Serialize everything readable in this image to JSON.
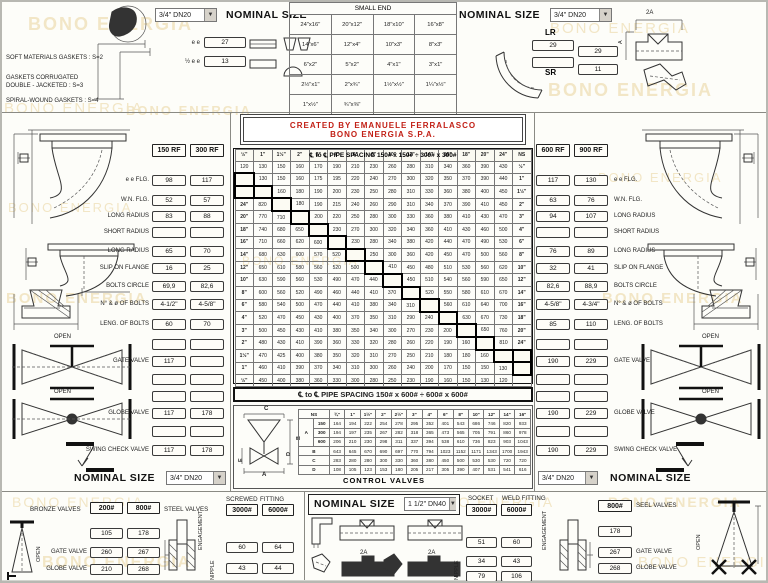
{
  "watermark_color": "#f2e6c6",
  "watermarks": [
    {
      "t": "BONO ENERGIA",
      "x": 26,
      "y": 12,
      "s": 18,
      "b": 1
    },
    {
      "t": "BONO ENERGIA",
      "x": 2,
      "y": 98,
      "s": 15,
      "b": 0
    },
    {
      "t": "BONO ENERGIA",
      "x": 124,
      "y": 101,
      "s": 13,
      "b": 1
    },
    {
      "t": "BONO ENERGIA",
      "x": 548,
      "y": 18,
      "s": 15,
      "b": 0
    },
    {
      "t": "BONO ENERGIA",
      "x": 546,
      "y": 78,
      "s": 18,
      "b": 1
    },
    {
      "t": "BONO ENERGIA",
      "x": 596,
      "y": 168,
      "s": 13,
      "b": 0
    },
    {
      "t": "BONO ENERGIA",
      "x": 600,
      "y": 288,
      "s": 15,
      "b": 1
    },
    {
      "t": "BONO ENERGIA",
      "x": 6,
      "y": 198,
      "s": 13,
      "b": 0
    },
    {
      "t": "BONO ENERGIA",
      "x": 4,
      "y": 288,
      "s": 15,
      "b": 1
    },
    {
      "t": "BONO ENERGIA",
      "x": 240,
      "y": 252,
      "s": 12,
      "b": 0
    },
    {
      "t": "BONO ENERGIA",
      "x": 10,
      "y": 492,
      "s": 14,
      "b": 0
    },
    {
      "t": "BONO ENERGIA",
      "x": 420,
      "y": 492,
      "s": 14,
      "b": 0
    },
    {
      "t": "BONO ENERGIA",
      "x": 606,
      "y": 492,
      "s": 14,
      "b": 1
    },
    {
      "t": "BONO ENERGIA",
      "x": 40,
      "y": 552,
      "s": 16,
      "b": 1
    },
    {
      "t": "BONO ENERGIA",
      "x": 636,
      "y": 552,
      "s": 15,
      "b": 0
    }
  ],
  "top_left": {
    "dropdown": "3/4\" DN20",
    "nominal_size": "NOMINAL SIZE",
    "dims": [
      {
        "label": "e e",
        "value": "27"
      },
      {
        "label": "½ e e",
        "value": "13"
      }
    ],
    "notes": [
      "SOFT MATERIALS GASKETS : S=2",
      "GASKETS CORRUGATED",
      "DOUBLE - JACKETED      : S=3",
      "SPIRAL-WOUND GASKETS  : S=4"
    ]
  },
  "small_end": {
    "title": "SMALL END",
    "rows": [
      [
        "24\"x16\"",
        "20\"x12\"",
        "18\"x10\"",
        "16\"x8\""
      ],
      [
        "14\"x6\"",
        "12\"x4\"",
        "10\"x3\"",
        "8\"x3\""
      ],
      [
        "6\"x2\"",
        "5\"x2\"",
        "4\"x1\"",
        "3\"x1\""
      ],
      [
        "2½\"x1\"",
        "2\"x¾\"",
        "1½\"x½\"",
        "1¼\"x½\""
      ],
      [
        "1\"x½\"",
        "¾\"x⅜\"",
        "",
        ""
      ]
    ]
  },
  "top_right": {
    "nominal_size": "NOMINAL SIZE",
    "dropdown": "3/4\" DN20",
    "lr_label": "LR",
    "sr_label": "SR",
    "lr_value": "29",
    "mid_value": "29",
    "sr_value": "11",
    "dim_2a": "2A",
    "dim_a": "A"
  },
  "credit": {
    "line1": "CREATED BY EMANUELE FERRALASCO",
    "line2": "BONO ENERGIA S.P.A."
  },
  "spacing": {
    "title": "℄ to ℄ PIPE SPACING 150# x 150# ÷ 300# x 300#",
    "top_header": [
      "½\"",
      "1\"",
      "1½\"",
      "2\"",
      "3\"",
      "4\"",
      "6\"",
      "8\"",
      "10\"",
      "12\"",
      "14\"",
      "16\"",
      "18\"",
      "20\"",
      "24\"",
      "NS"
    ],
    "bottom_header": [
      "NS",
      "24\"",
      "20\"",
      "18\"",
      "16\"",
      "14\"",
      "12\"",
      "10\"",
      "8\"",
      "6\"",
      "4\"",
      "3\"",
      "2\"",
      "1½\"",
      "1\"",
      "½\""
    ],
    "rows": [
      {
        "left": "",
        "right": "½\"",
        "cells": [
          120,
          130,
          150,
          160,
          170,
          190,
          210,
          230,
          260,
          280,
          310,
          340,
          360,
          390,
          430
        ]
      },
      {
        "left": "",
        "right": "1\"",
        "cells": [
          null,
          130,
          150,
          160,
          175,
          195,
          220,
          240,
          270,
          300,
          320,
          350,
          370,
          390,
          440
        ]
      },
      {
        "left": "",
        "right": "1½\"",
        "cells": [
          null,
          null,
          160,
          180,
          190,
          200,
          230,
          250,
          280,
          310,
          330,
          360,
          380,
          400,
          450
        ]
      },
      {
        "left": "24\"",
        "right": "2\"",
        "cells": [
          820,
          null,
          180,
          190,
          215,
          240,
          260,
          290,
          310,
          340,
          370,
          390,
          410,
          450
        ]
      },
      {
        "left": "20\"",
        "right": "3\"",
        "cells": [
          770,
          710,
          null,
          200,
          220,
          250,
          280,
          300,
          330,
          360,
          380,
          410,
          430,
          470
        ]
      },
      {
        "left": "18\"",
        "right": "4\"",
        "cells": [
          740,
          680,
          650,
          null,
          230,
          270,
          300,
          320,
          340,
          360,
          410,
          430,
          460,
          500
        ]
      },
      {
        "left": "16\"",
        "right": "6\"",
        "cells": [
          710,
          660,
          620,
          600,
          null,
          230,
          280,
          340,
          380,
          420,
          440,
          470,
          490,
          530
        ]
      },
      {
        "left": "14\"",
        "right": "8\"",
        "cells": [
          680,
          630,
          600,
          570,
          520,
          null,
          250,
          300,
          360,
          420,
          450,
          470,
          500,
          560
        ]
      },
      {
        "left": "12\"",
        "right": "10\"",
        "cells": [
          650,
          610,
          580,
          560,
          520,
          500,
          null,
          410,
          450,
          480,
          510,
          530,
          560,
          620
        ]
      },
      {
        "left": "10\"",
        "right": "12\"",
        "cells": [
          630,
          590,
          560,
          530,
          490,
          470,
          440,
          null,
          450,
          510,
          540,
          560,
          590,
          650
        ]
      },
      {
        "left": "8\"",
        "right": "14\"",
        "cells": [
          600,
          560,
          520,
          490,
          460,
          440,
          410,
          370,
          null,
          520,
          550,
          580,
          610,
          670
        ]
      },
      {
        "left": "6\"",
        "right": "16\"",
        "cells": [
          580,
          540,
          500,
          470,
          440,
          410,
          380,
          340,
          310,
          null,
          560,
          610,
          640,
          700
        ]
      },
      {
        "left": "4\"",
        "right": "18\"",
        "cells": [
          520,
          470,
          450,
          430,
          400,
          370,
          350,
          310,
          290,
          240,
          null,
          630,
          670,
          730
        ]
      },
      {
        "left": "3\"",
        "right": "20\"",
        "cells": [
          500,
          450,
          430,
          410,
          380,
          350,
          340,
          300,
          270,
          230,
          200,
          null,
          650,
          760
        ]
      },
      {
        "left": "2\"",
        "right": "24\"",
        "cells": [
          480,
          430,
          410,
          390,
          360,
          330,
          320,
          280,
          260,
          220,
          190,
          160,
          null,
          810
        ]
      },
      {
        "left": "1½\"",
        "right": "",
        "cells": [
          470,
          425,
          400,
          380,
          350,
          320,
          310,
          270,
          250,
          210,
          180,
          180,
          160,
          null
        ]
      },
      {
        "left": "1\"",
        "right": "",
        "cells": [
          460,
          410,
          390,
          370,
          340,
          310,
          300,
          260,
          240,
          200,
          170,
          150,
          150,
          130
        ]
      },
      {
        "left": "½\"",
        "right": "",
        "cells": [
          450,
          400,
          380,
          360,
          330,
          300,
          280,
          250,
          230,
          190,
          160,
          150,
          130,
          120
        ]
      }
    ]
  },
  "band2": "℄ to ℄ PIPE SPACING 150# x 600# ÷ 600# x 600#",
  "control_valves": {
    "title": "CONTROL VALVES",
    "ns_label": "NS",
    "header": [
      "¾\"",
      "1\"",
      "1½\"",
      "2\"",
      "2½\"",
      "3\"",
      "4\"",
      "6\"",
      "8\"",
      "10\"",
      "12\"",
      "14\"",
      "16\""
    ],
    "group_a": {
      "label": "A",
      "subrows": [
        {
          "label": "150",
          "values": [
            164,
            194,
            222,
            254,
            278,
            295,
            352,
            401,
            543,
            686,
            746,
            820,
            933
          ]
        },
        {
          "label": "300",
          "values": [
            194,
            197,
            235,
            267,
            282,
            318,
            365,
            473,
            565,
            705,
            791,
            860,
            978
          ]
        },
        {
          "label": "600",
          "values": [
            206,
            210,
            230,
            298,
            311,
            337,
            394,
            538,
            610,
            736,
            823,
            903,
            1043
          ]
        }
      ]
    },
    "rows": [
      {
        "label": "B",
        "values": [
          643,
          645,
          670,
          690,
          697,
          770,
          794,
          1023,
          1152,
          1171,
          1343,
          1700,
          1943
        ]
      },
      {
        "label": "C",
        "values": [
          283,
          280,
          280,
          300,
          330,
          360,
          380,
          450,
          500,
          530,
          530,
          720,
          720
        ]
      },
      {
        "label": "D",
        "values": [
          108,
          105,
          123,
          153,
          180,
          205,
          217,
          305,
          390,
          407,
          531,
          541,
          616
        ]
      }
    ],
    "drawing_letters": {
      "top": "C",
      "right": "B",
      "left": "E",
      "bottom": "A",
      "mid": "D"
    }
  },
  "left_panel": {
    "headers": [
      "150 RF",
      "300 RF"
    ],
    "rows": [
      {
        "label": "e e FLG.",
        "v": [
          "98",
          "117"
        ]
      },
      {
        "label": "W.N. FLG.",
        "v": [
          "52",
          "57"
        ]
      },
      {
        "label": "LONG RADIUS",
        "v": [
          "83",
          "88"
        ]
      },
      {
        "label": "SHORT RADIUS",
        "v": [
          "",
          ""
        ]
      },
      {
        "label": "LONG RADIUS",
        "v": [
          "65",
          "70"
        ]
      },
      {
        "label": "SLIP ON FLANGE",
        "v": [
          "16",
          "25"
        ]
      },
      {
        "label": "BOLTS CIRCLE",
        "v": [
          "69,9",
          "82,6"
        ]
      },
      {
        "label": "N° & ø OF BOLTS",
        "v": [
          "4-1/2\"",
          "4-5/8\""
        ]
      },
      {
        "label": "LENG. OF BOLTS",
        "v": [
          "60",
          "70"
        ]
      }
    ]
  },
  "right_panel": {
    "headers": [
      "600 RF",
      "900 RF"
    ],
    "rows": [
      {
        "label": "e e FLG.",
        "v": [
          "117",
          "130"
        ]
      },
      {
        "label": "W.N. FLG.",
        "v": [
          "63",
          "76"
        ]
      },
      {
        "label": "LONG RADIUS",
        "v": [
          "94",
          "107"
        ]
      },
      {
        "label": "SHORT RADIUS",
        "v": [
          "",
          ""
        ]
      },
      {
        "label": "LONG RADIUS",
        "v": [
          "76",
          "89"
        ]
      },
      {
        "label": "SLIP ON FLANGE",
        "v": [
          "32",
          "41"
        ]
      },
      {
        "label": "BOLTS CIRCLE",
        "v": [
          "82,6",
          "88,9"
        ]
      },
      {
        "label": "N° & ø OF BOLTS",
        "v": [
          "4-5/8\"",
          "4-3/4\""
        ]
      },
      {
        "label": "LENG. OF BOLTS",
        "v": [
          "85",
          "110"
        ]
      }
    ]
  },
  "left_valves": {
    "open": "OPEN",
    "rows": [
      {
        "label": "",
        "v": [
          "",
          ""
        ]
      },
      {
        "label": "GATE VALVE",
        "v": [
          "117",
          ""
        ]
      },
      {
        "label": "",
        "v": [
          "",
          ""
        ]
      },
      {
        "label": "",
        "v": [
          "",
          ""
        ]
      },
      {
        "label": "GLOBE VALVE",
        "v": [
          "117",
          "178"
        ]
      },
      {
        "label": "",
        "v": [
          "",
          ""
        ]
      },
      {
        "label": "SWING CHECK VALVE",
        "v": [
          "117",
          "178"
        ]
      }
    ],
    "nominal_size": "NOMINAL SIZE",
    "dropdown": "3/4\" DN20"
  },
  "right_valves": {
    "open": "OPEN",
    "rows": [
      {
        "label": "",
        "v": [
          "",
          ""
        ]
      },
      {
        "label": "GATE VALVE",
        "v": [
          "190",
          "229"
        ]
      },
      {
        "label": "",
        "v": [
          "",
          ""
        ]
      },
      {
        "label": "",
        "v": [
          "",
          ""
        ]
      },
      {
        "label": "GLOBE VALVE",
        "v": [
          "190",
          "229"
        ]
      },
      {
        "label": "",
        "v": [
          "",
          ""
        ]
      },
      {
        "label": "SWING CHECK VALVE",
        "v": [
          "190",
          "229"
        ]
      }
    ],
    "nominal_size": "NOMINAL SIZE",
    "dropdown": "3/4\" DN20"
  },
  "bottom_left": {
    "bronze_label": "BRONZE VALVES",
    "steel_label": "STEEL VALVES",
    "col1": "200#",
    "col2": "800#",
    "rows": [
      {
        "label": "",
        "v": [
          "105",
          "178"
        ]
      },
      {
        "label": "GATE VALVE",
        "v": [
          "260",
          "267"
        ]
      },
      {
        "label": "GLOBE VALVE",
        "v": [
          "210",
          "268"
        ]
      }
    ],
    "open": "OPEN",
    "screwed": "SCREWED",
    "fitting": "FITTING",
    "sc1": "3000#",
    "sc2": "6000#",
    "screwed_rows": [
      [
        "60",
        "64"
      ],
      [
        "43",
        "44"
      ]
    ],
    "engagement": "ENGAGEMENT",
    "nipple": "NIPPLE"
  },
  "bottom_mid": {
    "nominal_size": "NOMINAL SIZE",
    "dropdown": "1 1/2\" DN40",
    "dim_2a": "2A",
    "dim_a": "A",
    "socket": "SOCKET",
    "weld_fitting": "WELD FITTING",
    "sc1": "3000#",
    "sc2": "6000#",
    "socket_rows": [
      [
        "51",
        "60"
      ],
      [
        "34",
        "43"
      ],
      [
        "79",
        "106"
      ]
    ],
    "engagement": "ENGAGEMENT",
    "nipple": "NIPPLE"
  },
  "bottom_right": {
    "col": "800#",
    "label": "SEEL VALVES",
    "rows": [
      {
        "label": "",
        "v": "178"
      },
      {
        "label": "GATE VALVE",
        "v": "267"
      },
      {
        "label": "GLOBE VALVE",
        "v": "268"
      }
    ],
    "open": "OPEN"
  }
}
